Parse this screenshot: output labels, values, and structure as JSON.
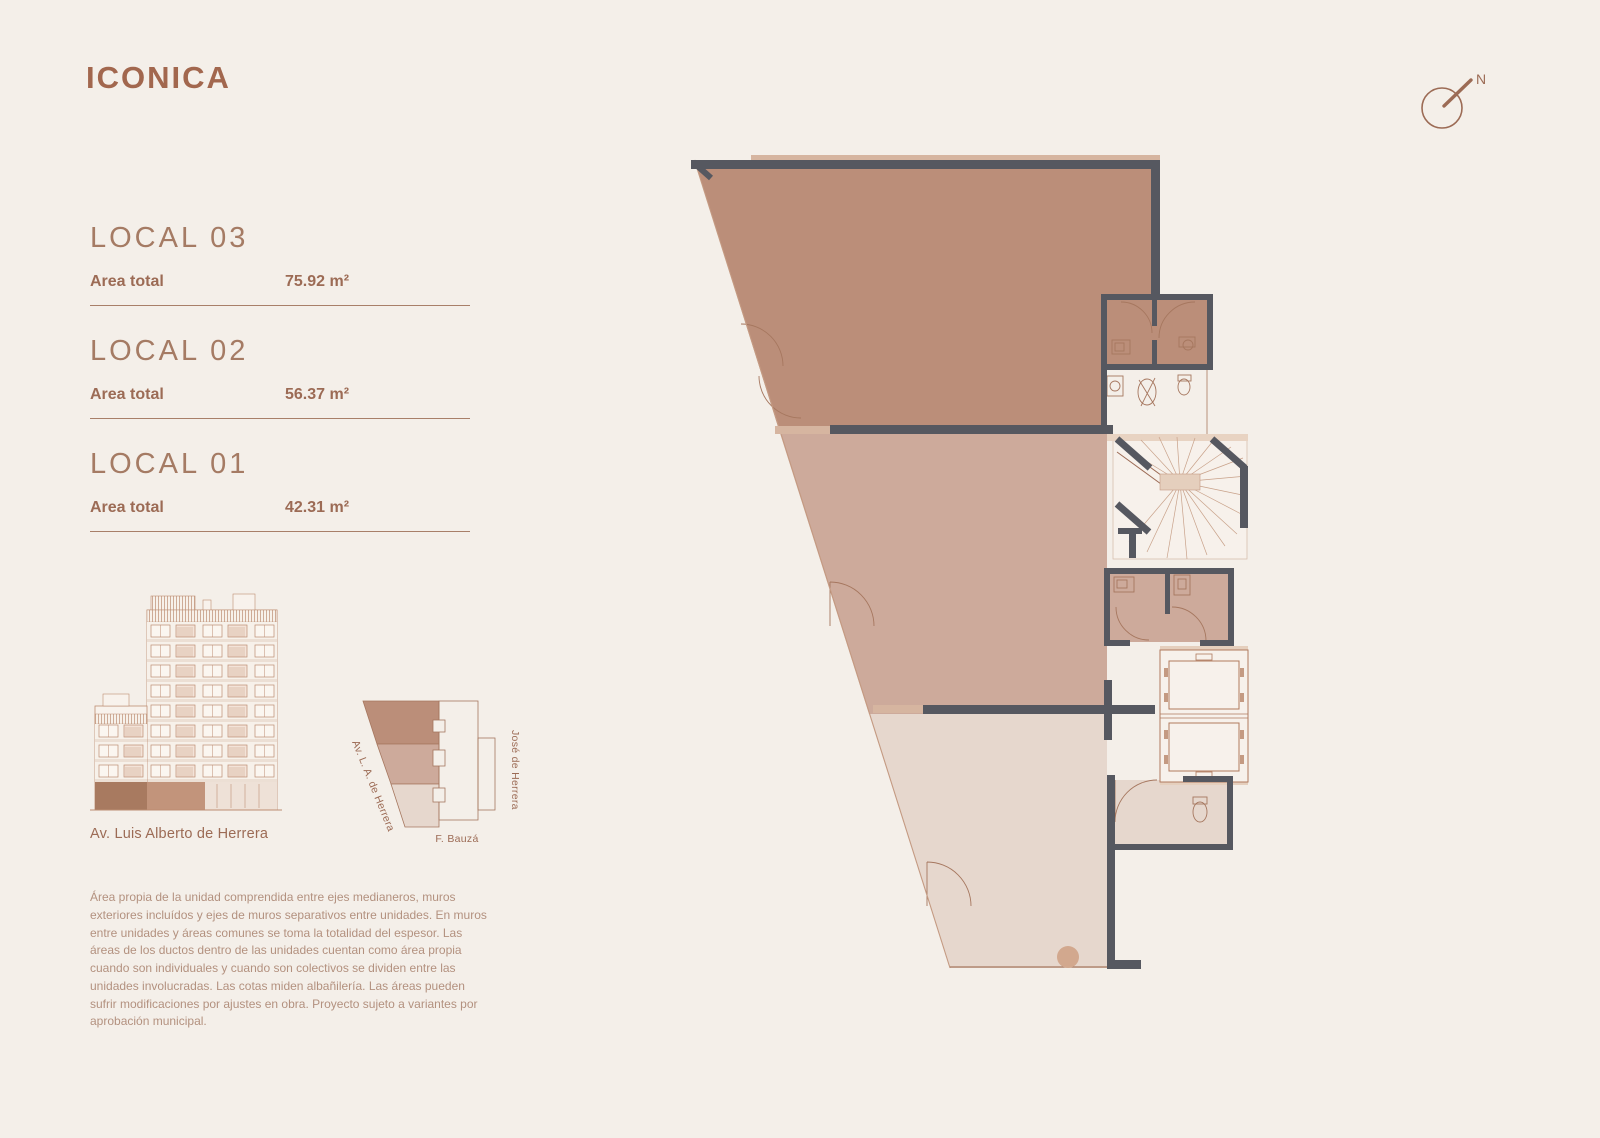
{
  "brand": {
    "logo": "ICONICA"
  },
  "locals": [
    {
      "name": "LOCAL 03",
      "area_label": "Area total",
      "area_value": "75.92 m²"
    },
    {
      "name": "LOCAL 02",
      "area_label": "Area total",
      "area_value": "56.37 m²"
    },
    {
      "name": "LOCAL 01",
      "area_label": "Area total",
      "area_value": "42.31 m²"
    }
  ],
  "elevation": {
    "caption": "Av. Luis Alberto de Herrera"
  },
  "site_map": {
    "street_left": "Av. L. A. de Herrera",
    "street_right": "José de Herrera",
    "street_bottom": "F. Bauzá"
  },
  "compass": {
    "label": "N"
  },
  "disclaimer": {
    "text": "Área propia de la unidad comprendida entre ejes medianeros, muros exteriores incluídos y ejes de muros separativos entre unidades. En muros entre unidades y áreas comunes se toma la totalidad del espesor. Las áreas de los ductos dentro de las unidades cuentan como área propia cuando son individuales y cuando son colectivos se dividen entre las unidades involucradas. Las cotas miden albañilería. Las áreas pueden sufrir modificaciones por ajustes en obra. Proyecto sujeto a variantes por aprobación municipal."
  },
  "colors": {
    "background": "#f4efe9",
    "accent": "#9c6b55",
    "logo": "#a2674e",
    "heading": "#a57b64",
    "muted_text": "#b3917f",
    "wall": "#565860",
    "local_03_fill": "#bb8e79",
    "local_02_fill": "#cdaa9b",
    "local_01_fill": "#e6d7cd",
    "plan_line": "#a6775f"
  }
}
